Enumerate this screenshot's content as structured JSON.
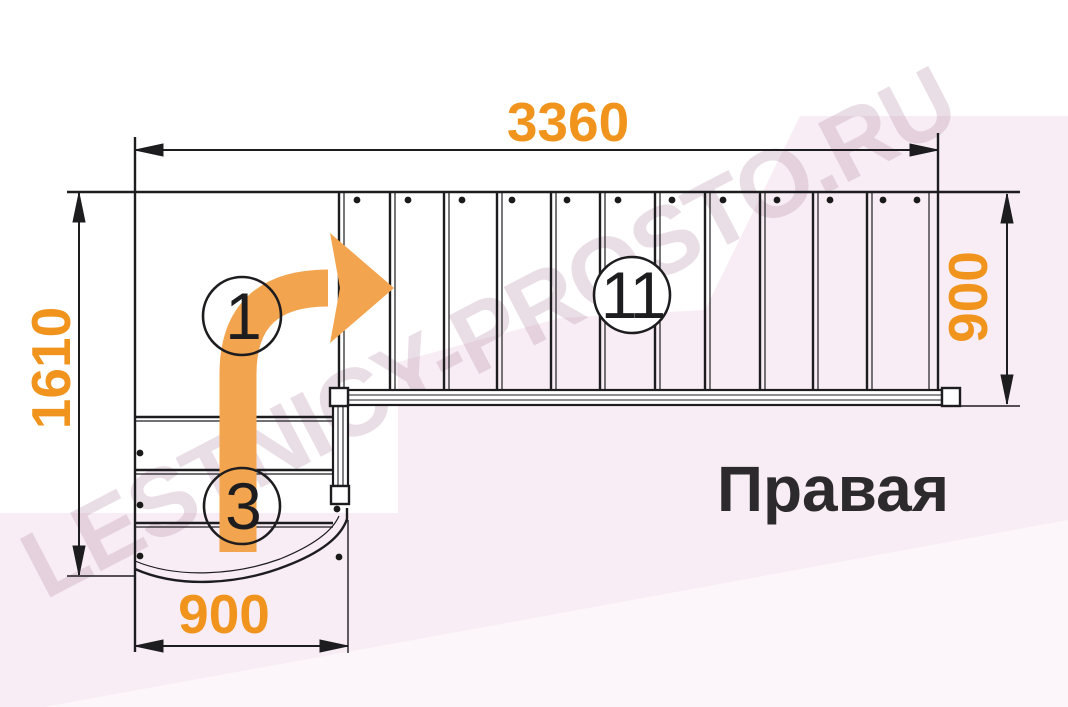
{
  "watermark": {
    "text": "LESTNICY-PROSTO.RU",
    "color": "rgba(172,134,158,0.27)"
  },
  "dimensions": {
    "top": {
      "value": "3360"
    },
    "left": {
      "value": "1610"
    },
    "right": {
      "value": "900"
    },
    "bottom": {
      "value": "900"
    }
  },
  "step_labels": [
    {
      "value": "1"
    },
    {
      "value": "3"
    },
    {
      "value": "11"
    }
  ],
  "caption": {
    "text": "Правая"
  },
  "colors": {
    "dimension_text": "#f0941d",
    "walk_arrow": "#f2a44e",
    "drawing_line": "#1d1d20",
    "background_pink": "#f8edf4",
    "background_pink_light": "#fcf5f9",
    "caption_text": "#2d2a2d"
  },
  "icons": {
    "direction_arrow": "curved-right-arrow"
  }
}
